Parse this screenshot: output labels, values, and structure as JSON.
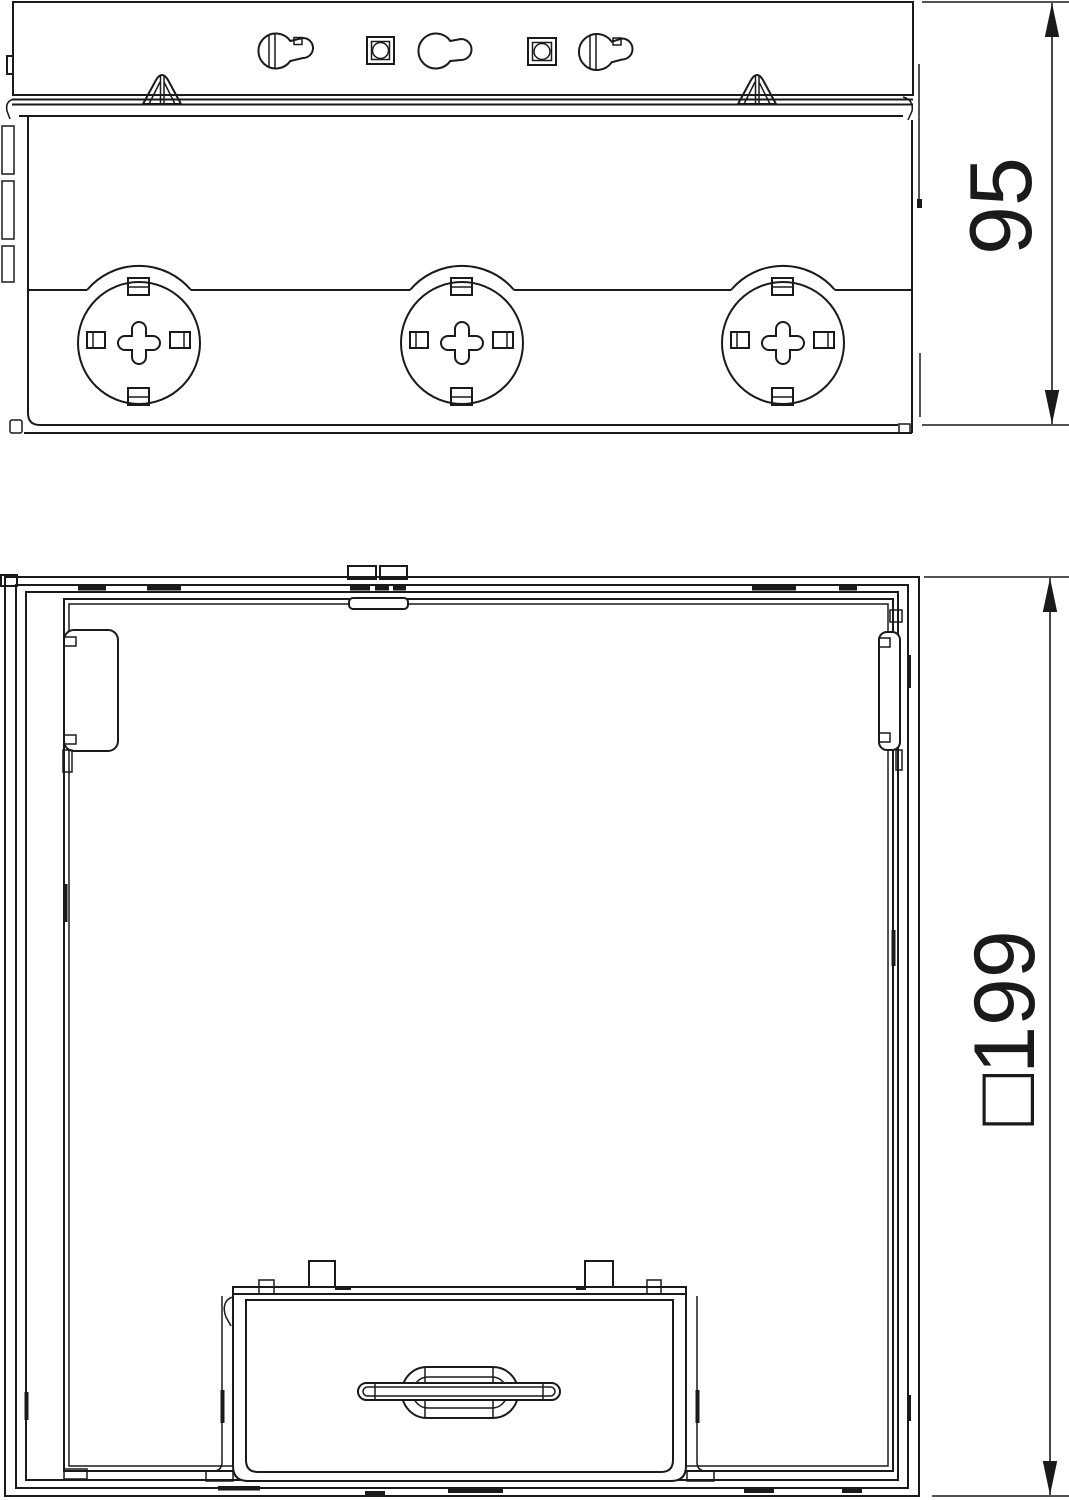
{
  "drawing": {
    "background": "#ffffff",
    "line_color": "#1a1a1a",
    "views": [
      {
        "id": "side-view",
        "label": "Side view",
        "features": [
          "mounting-keyholes",
          "knockouts-x3",
          "fixing-clips-x2"
        ],
        "dimension": {
          "value": "95",
          "orientation": "vertical"
        }
      },
      {
        "id": "plan-view",
        "label": "Plan view",
        "features": [
          "square-frame",
          "latch-pads",
          "cover-with-handle"
        ],
        "dimension": {
          "value": "□199",
          "orientation": "vertical"
        }
      }
    ]
  }
}
